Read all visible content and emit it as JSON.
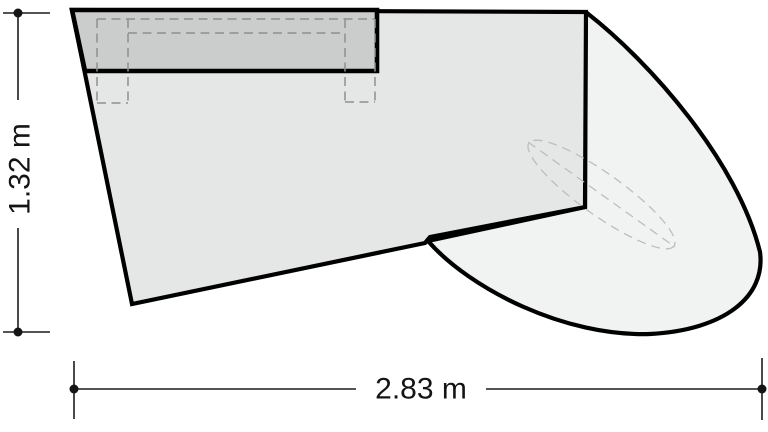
{
  "drawing": {
    "dimensions": {
      "height": {
        "label": "1.32 m"
      },
      "width": {
        "label": "2.83 m"
      }
    }
  },
  "colors": {
    "background": "#ffffff",
    "outline": "#000000",
    "surface_fill": "#e5e6e6",
    "panel_fill": "#cbcdcd",
    "extension_fill": "#f1f3f3",
    "hidden_edge": "#8f8f8f",
    "guide": "#b9bfbf",
    "dimension": "#1c1c1c"
  }
}
